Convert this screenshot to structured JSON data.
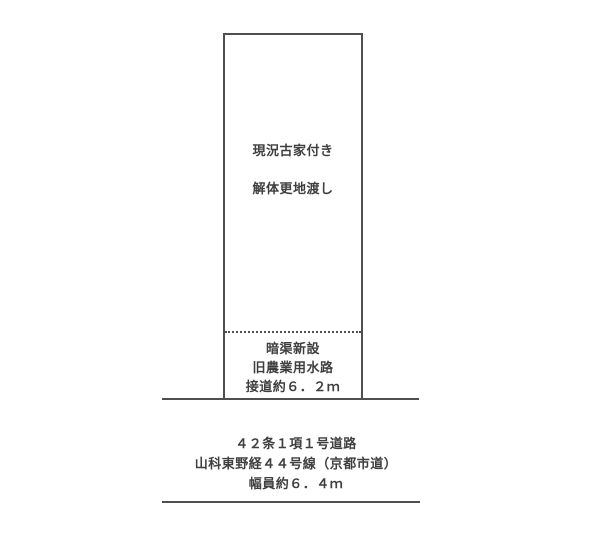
{
  "diagram": {
    "colors": {
      "background": "#ffffff",
      "line": "#4f4f4f",
      "text": "#3f3f3f"
    },
    "parcel": {
      "notes_top": [
        "現況古家付き",
        "解体更地渡し"
      ],
      "notes_bottom": [
        "暗渠新設",
        "旧農業用水路",
        "接道約６．２ｍ"
      ]
    },
    "road": {
      "labels": [
        "４２条１項１号道路",
        "山科東野経４４号線（京都市道）",
        "幅員約６．４ｍ"
      ]
    }
  }
}
